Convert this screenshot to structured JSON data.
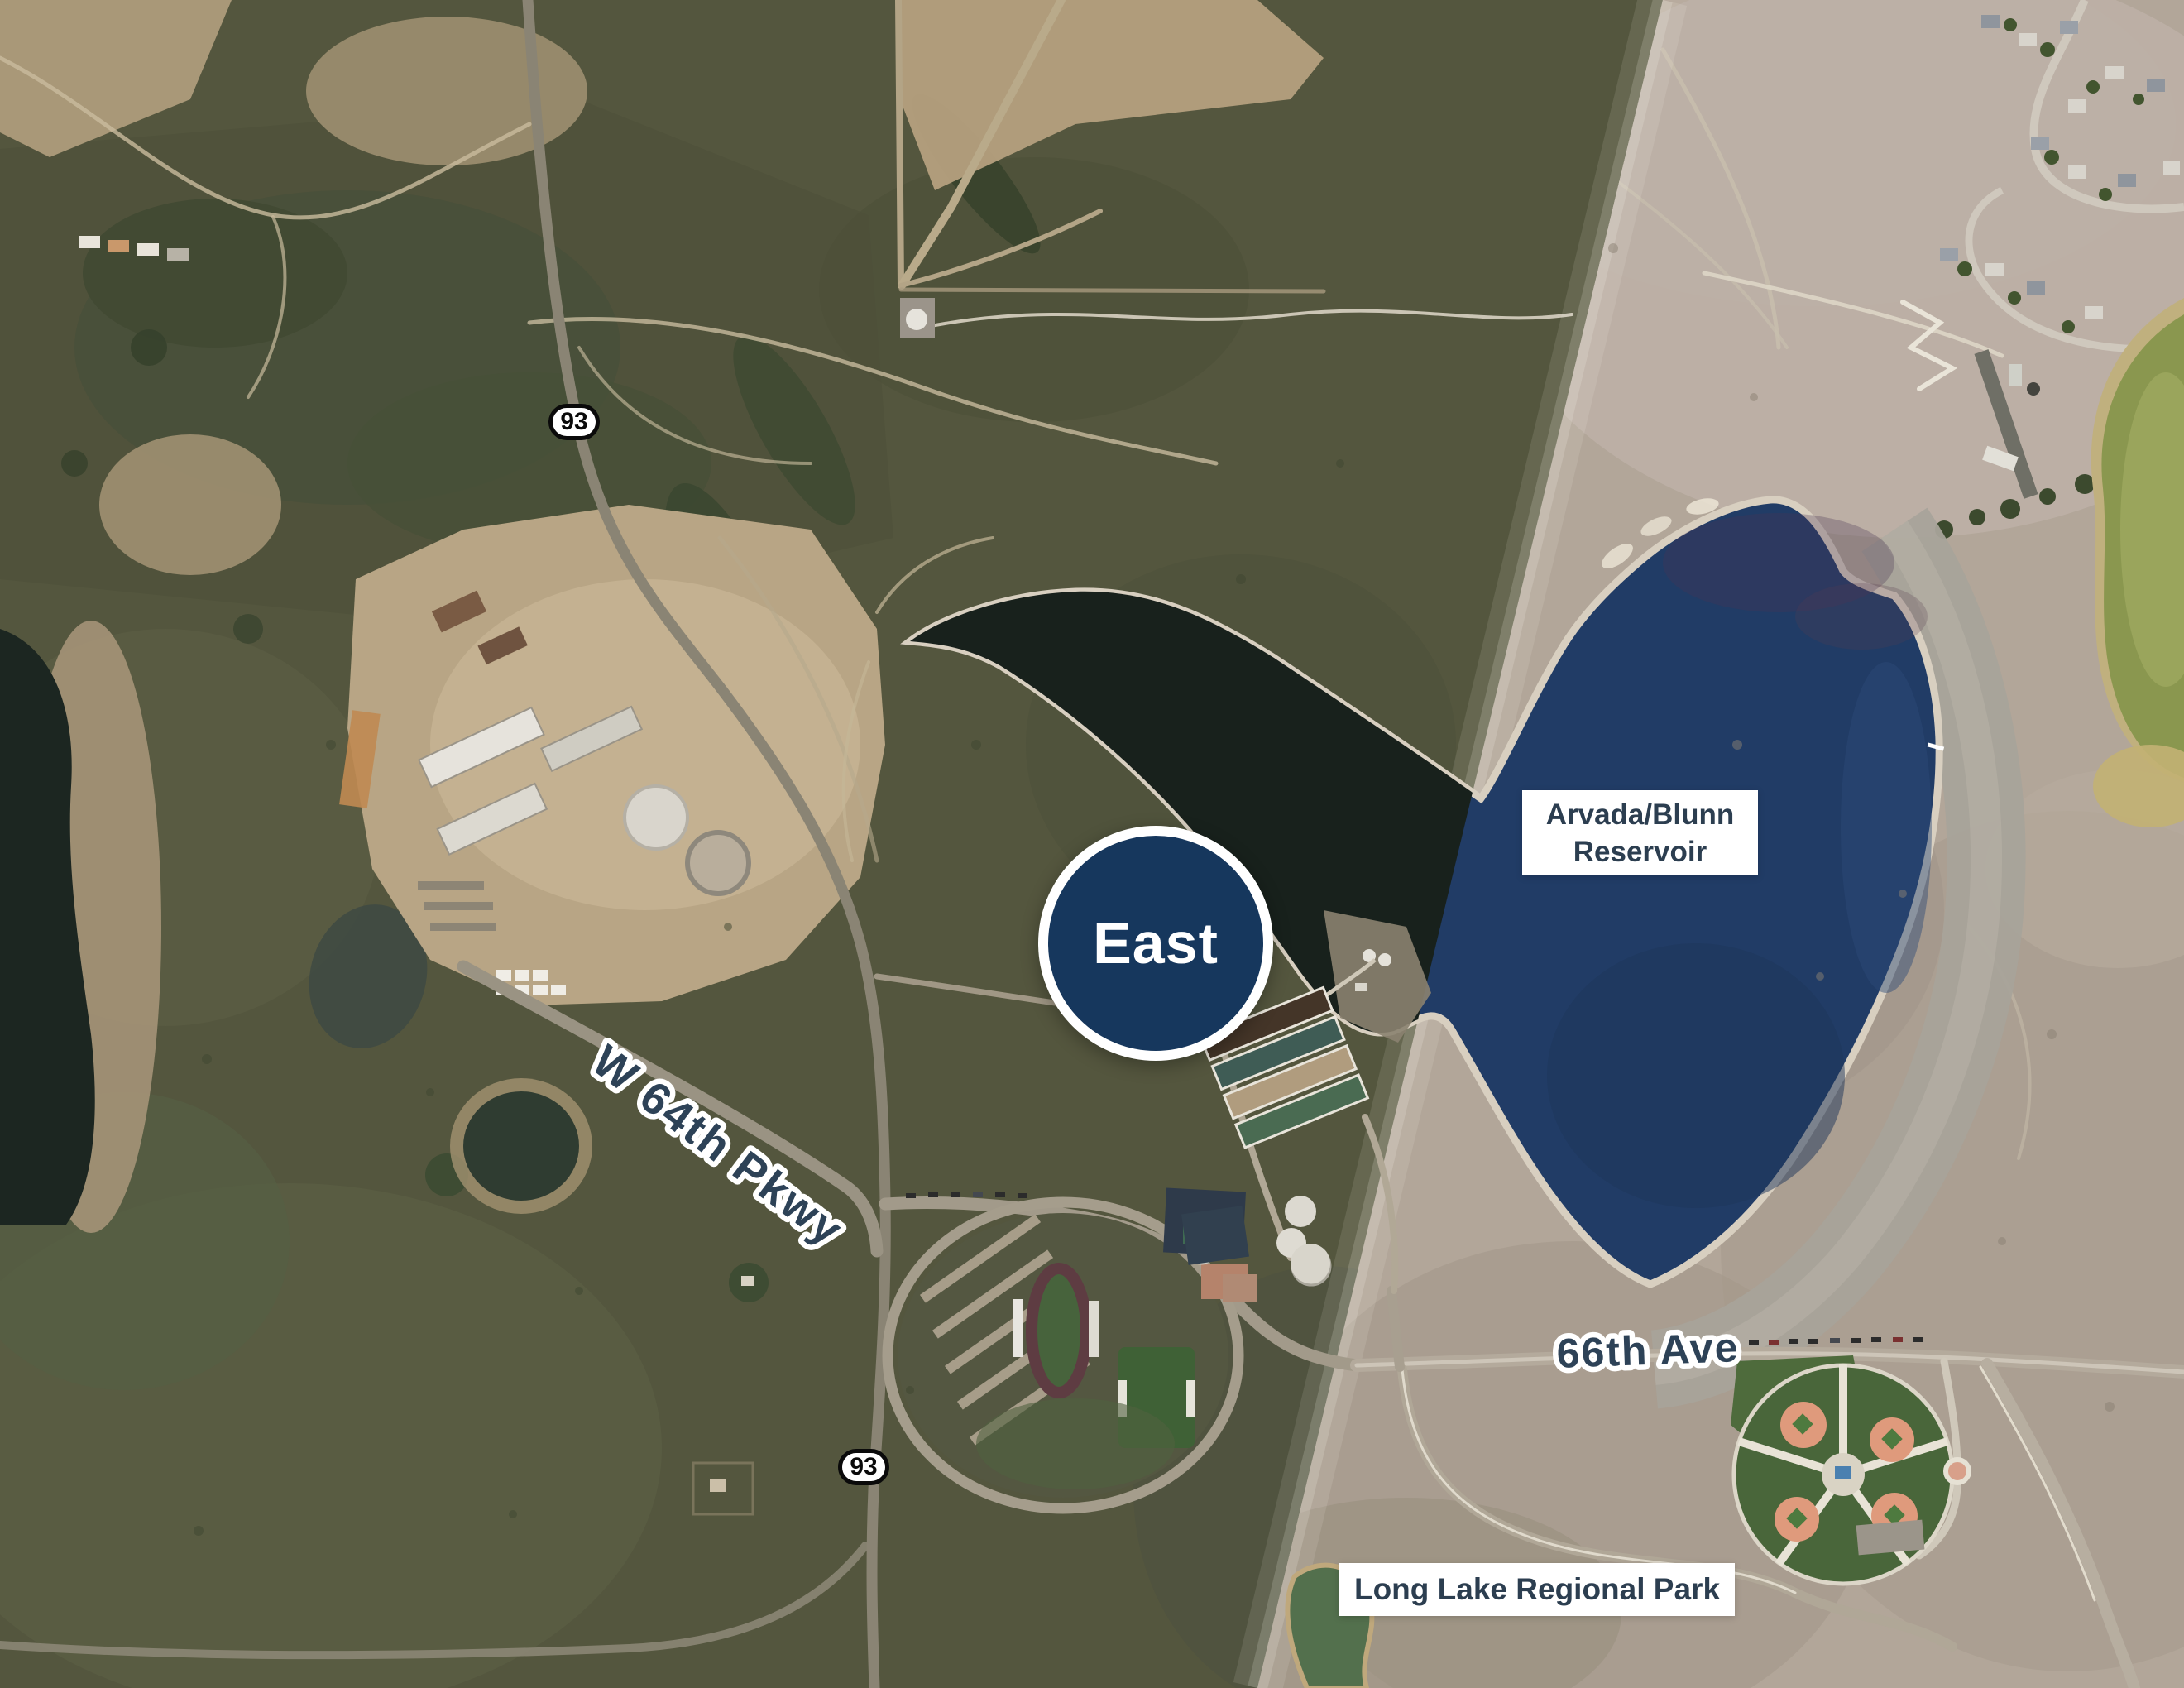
{
  "map": {
    "region_marker": {
      "label": "East"
    },
    "place_labels": {
      "reservoir": {
        "line1": "Arvada/Blunn",
        "line2": "Reservoir"
      },
      "park": {
        "text": "Long Lake Regional Park"
      }
    },
    "road_labels": {
      "pkwy": "W 64th Pkwy",
      "ave": "66th Ave"
    },
    "highway_shields": {
      "north": "93",
      "south": "93"
    },
    "colors": {
      "marker_fill": "#16375d",
      "marker_ring": "#ffffff",
      "label_box_bg": "#ffffff",
      "label_text": "#2c3e50",
      "road_label_text": "#2d4257",
      "road_label_outline": "#ffffff",
      "shield_bg": "#ffffff",
      "shield_border": "#0a0a0a",
      "water_navy": "#213c66",
      "water_dark": "#18211c",
      "terrain_dark": "#54563e",
      "terrain_bright": "#b2a699"
    }
  }
}
